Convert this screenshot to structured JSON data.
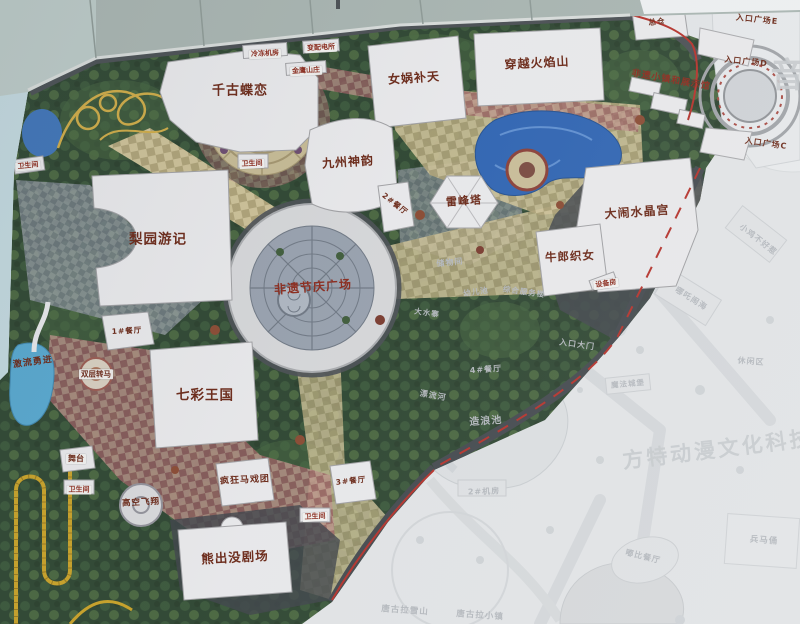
{
  "photo_meta": {
    "subject": "theme park master plan map board"
  },
  "colors": {
    "boundary_red": "#b5312a",
    "attraction_label": "#6b2817",
    "plaza_label_red": "#8b2a1c",
    "faded_label": "#b4b8bd",
    "water_blue": "#2f64b2",
    "foliage_green": "#2e4631",
    "path_tan": "#cdc197"
  },
  "map": {
    "labels": [
      {
        "id": "qiangudielian",
        "text": "千古蝶恋",
        "cls": "attraction",
        "x": 240,
        "y": 91,
        "fs": 13,
        "rot": 0,
        "tag": false
      },
      {
        "id": "nuwabutian",
        "text": "女娲补天",
        "cls": "attraction",
        "x": 414,
        "y": 78,
        "fs": 12,
        "rot": -4,
        "tag": false
      },
      {
        "id": "chuanyuehuoyanshan",
        "text": "穿越火焰山",
        "cls": "attraction",
        "x": 537,
        "y": 63,
        "fs": 12,
        "rot": -3,
        "tag": false
      },
      {
        "id": "jiuzhoushenyun",
        "text": "九州神韵",
        "cls": "attraction",
        "x": 348,
        "y": 162,
        "fs": 12,
        "rot": -4,
        "tag": false
      },
      {
        "id": "leifengta",
        "text": "雷峰塔",
        "cls": "attraction",
        "x": 464,
        "y": 201,
        "fs": 11,
        "rot": -4,
        "tag": false
      },
      {
        "id": "danaoshuijinggong",
        "text": "大闹水晶宫",
        "cls": "attraction",
        "x": 637,
        "y": 212,
        "fs": 12,
        "rot": -4,
        "tag": false
      },
      {
        "id": "niulangzhinv",
        "text": "牛郎织女",
        "cls": "attraction",
        "x": 570,
        "y": 257,
        "fs": 11.5,
        "rot": -3,
        "tag": false
      },
      {
        "id": "liyuanyouji",
        "text": "梨园游记",
        "cls": "attraction",
        "x": 158,
        "y": 240,
        "fs": 13.5,
        "rot": 0,
        "tag": false
      },
      {
        "id": "qicaiwangguo",
        "text": "七彩王国",
        "cls": "attraction",
        "x": 205,
        "y": 396,
        "fs": 13.5,
        "rot": 0,
        "tag": false
      },
      {
        "id": "xiongchumojuchang",
        "text": "熊出没剧场",
        "cls": "attraction",
        "x": 235,
        "y": 558,
        "fs": 12.5,
        "rot": -3,
        "tag": false
      },
      {
        "id": "fengkuangmaxituan",
        "text": "疯狂马戏团",
        "cls": "attraction",
        "x": 245,
        "y": 481,
        "fs": 9,
        "rot": -3,
        "tag": false
      },
      {
        "id": "gaokongfeixiang",
        "text": "高空飞翔",
        "cls": "attraction",
        "x": 141,
        "y": 503,
        "fs": 8.5,
        "rot": -3,
        "tag": false
      },
      {
        "id": "shuangcengzhuanma",
        "text": "双层转马",
        "cls": "attraction",
        "x": 96,
        "y": 374,
        "fs": 7.5,
        "rot": 0,
        "tag": true
      },
      {
        "id": "jiliuyongjin",
        "text": "激流勇进",
        "cls": "attraction",
        "x": 33,
        "y": 363,
        "fs": 9,
        "rot": -8,
        "tag": false
      },
      {
        "id": "wutai",
        "text": "舞台",
        "cls": "attraction",
        "x": 76,
        "y": 459,
        "fs": 8,
        "rot": 0,
        "tag": true
      },
      {
        "id": "feiyijieqingguangchang",
        "text": "非遗节庆广场",
        "cls": "red",
        "x": 313,
        "y": 287,
        "fs": 12,
        "rot": -4,
        "tag": false
      },
      {
        "id": "feiyixiaozhen",
        "text": "非遗小镇和展示馆",
        "cls": "red",
        "x": 671,
        "y": 81,
        "fs": 9,
        "rot": 10,
        "tag": false
      },
      {
        "id": "jinyingshanzhuang",
        "text": "金鹰山庄",
        "cls": "red",
        "x": 306,
        "y": 71,
        "fs": 7,
        "rot": -3,
        "tag": true
      },
      {
        "id": "rukouguangchang-e",
        "text": "入口广场E",
        "cls": "attraction",
        "x": 757,
        "y": 20,
        "fs": 8,
        "rot": 6,
        "tag": false
      },
      {
        "id": "rukouguangchang-d",
        "text": "入口广场D",
        "cls": "attraction",
        "x": 746,
        "y": 62,
        "fs": 8,
        "rot": 6,
        "tag": false
      },
      {
        "id": "rukouguangchang-c",
        "text": "入口广场C",
        "cls": "attraction",
        "x": 766,
        "y": 144,
        "fs": 8,
        "rot": 8,
        "tag": false
      },
      {
        "id": "zongcang",
        "text": "总仓",
        "cls": "attraction",
        "x": 657,
        "y": 22,
        "fs": 7.5,
        "rot": -6,
        "tag": false
      },
      {
        "id": "lengdongjifang",
        "text": "冷冻机房",
        "cls": "red",
        "x": 265,
        "y": 54,
        "fs": 7,
        "rot": -3,
        "tag": true
      },
      {
        "id": "bianpeidiansuo",
        "text": "变配电所",
        "cls": "red",
        "x": 321,
        "y": 48,
        "fs": 7,
        "rot": -3,
        "tag": true
      },
      {
        "id": "shebeifang",
        "text": "设备房",
        "cls": "red",
        "x": 606,
        "y": 284,
        "fs": 7,
        "rot": -8,
        "tag": true
      },
      {
        "id": "weishengjian-a",
        "text": "卫生间",
        "cls": "red",
        "x": 28,
        "y": 166,
        "fs": 7,
        "rot": -6,
        "tag": true
      },
      {
        "id": "weishengjian-b",
        "text": "卫生间",
        "cls": "red",
        "x": 252,
        "y": 164,
        "fs": 7,
        "rot": -3,
        "tag": true
      },
      {
        "id": "weishengjian-c",
        "text": "卫生间",
        "cls": "red",
        "x": 79,
        "y": 490,
        "fs": 7,
        "rot": 0,
        "tag": true
      },
      {
        "id": "weishengjian-d",
        "text": "卫生间",
        "cls": "red",
        "x": 315,
        "y": 517,
        "fs": 7,
        "rot": -3,
        "tag": true
      },
      {
        "id": "canting-1",
        "text": "1#餐厅",
        "cls": "attraction",
        "x": 127,
        "y": 331,
        "fs": 7.5,
        "rot": -3,
        "tag": false
      },
      {
        "id": "canting-2",
        "text": "2#餐厅",
        "cls": "attraction",
        "x": 395,
        "y": 204,
        "fs": 7.5,
        "rot": 38,
        "tag": false
      },
      {
        "id": "canting-3",
        "text": "3#餐厅",
        "cls": "attraction",
        "x": 351,
        "y": 481,
        "fs": 7.5,
        "rot": -6,
        "tag": false
      },
      {
        "id": "chuwujian",
        "text": "储物间",
        "cls": "faded",
        "x": 450,
        "y": 263,
        "fs": 8,
        "rot": -6,
        "tag": false
      },
      {
        "id": "youerchi",
        "text": "幼儿池",
        "cls": "faded",
        "x": 476,
        "y": 292,
        "fs": 7.5,
        "rot": -8,
        "tag": false
      },
      {
        "id": "zonghefuwulou",
        "text": "综合服务楼",
        "cls": "faded",
        "x": 524,
        "y": 292,
        "fs": 7.5,
        "rot": 8,
        "tag": false
      },
      {
        "id": "dashuizhai",
        "text": "大水寨",
        "cls": "faded",
        "x": 427,
        "y": 313,
        "fs": 7.5,
        "rot": 8,
        "tag": false
      },
      {
        "id": "canting-4",
        "text": "4#餐厅",
        "cls": "faded",
        "x": 486,
        "y": 370,
        "fs": 8,
        "rot": -4,
        "tag": false
      },
      {
        "id": "piaoliuhe",
        "text": "漂流河",
        "cls": "faded",
        "x": 433,
        "y": 396,
        "fs": 8,
        "rot": 10,
        "tag": false
      },
      {
        "id": "zaolangchi",
        "text": "造浪池",
        "cls": "faded",
        "x": 486,
        "y": 422,
        "fs": 10,
        "rot": -4,
        "tag": false
      },
      {
        "id": "jifang-2",
        "text": "2#机房",
        "cls": "faded",
        "x": 484,
        "y": 492,
        "fs": 8,
        "rot": -2,
        "tag": false
      },
      {
        "id": "rukoudamen",
        "text": "入口大门",
        "cls": "faded",
        "x": 577,
        "y": 345,
        "fs": 8,
        "rot": 8,
        "tag": false
      },
      {
        "id": "xiaojibuhaore",
        "text": "小鸡不好惹",
        "cls": "faded",
        "x": 758,
        "y": 240,
        "fs": 8,
        "rot": 38,
        "tag": false
      },
      {
        "id": "nezhanaohai",
        "text": "哪吒闹海",
        "cls": "faded",
        "x": 691,
        "y": 299,
        "fs": 8,
        "rot": 32,
        "tag": false
      },
      {
        "id": "xiuxianqu",
        "text": "休闲区",
        "cls": "faded",
        "x": 751,
        "y": 362,
        "fs": 8,
        "rot": 4,
        "tag": false
      },
      {
        "id": "mofachengbao",
        "text": "魔法城堡",
        "cls": "faded",
        "x": 628,
        "y": 384,
        "fs": 7.5,
        "rot": -5,
        "tag": false
      },
      {
        "id": "dubicanting",
        "text": "嘟比餐厅",
        "cls": "faded",
        "x": 643,
        "y": 557,
        "fs": 8,
        "rot": 14,
        "tag": false
      },
      {
        "id": "bingmayong",
        "text": "兵马俑",
        "cls": "faded",
        "x": 764,
        "y": 541,
        "fs": 8.5,
        "rot": 4,
        "tag": false
      },
      {
        "id": "tanggulaxueshan",
        "text": "唐古拉雪山",
        "cls": "faded",
        "x": 405,
        "y": 611,
        "fs": 8.5,
        "rot": 4,
        "tag": false
      },
      {
        "id": "tanggulaxiaozhen",
        "text": "唐古拉小镇",
        "cls": "faded",
        "x": 480,
        "y": 616,
        "fs": 8.5,
        "rot": 4,
        "tag": false
      },
      {
        "id": "fangte-watermark",
        "text": "方特动漫文化科技",
        "cls": "watermark",
        "x": 718,
        "y": 450,
        "fs": 21,
        "rot": -7,
        "tag": false
      },
      {
        "id": "yin-watermark",
        "text": "音",
        "cls": "watermark",
        "x": 789,
        "y": 76,
        "fs": 34,
        "rot": 0,
        "tag": false
      }
    ]
  }
}
